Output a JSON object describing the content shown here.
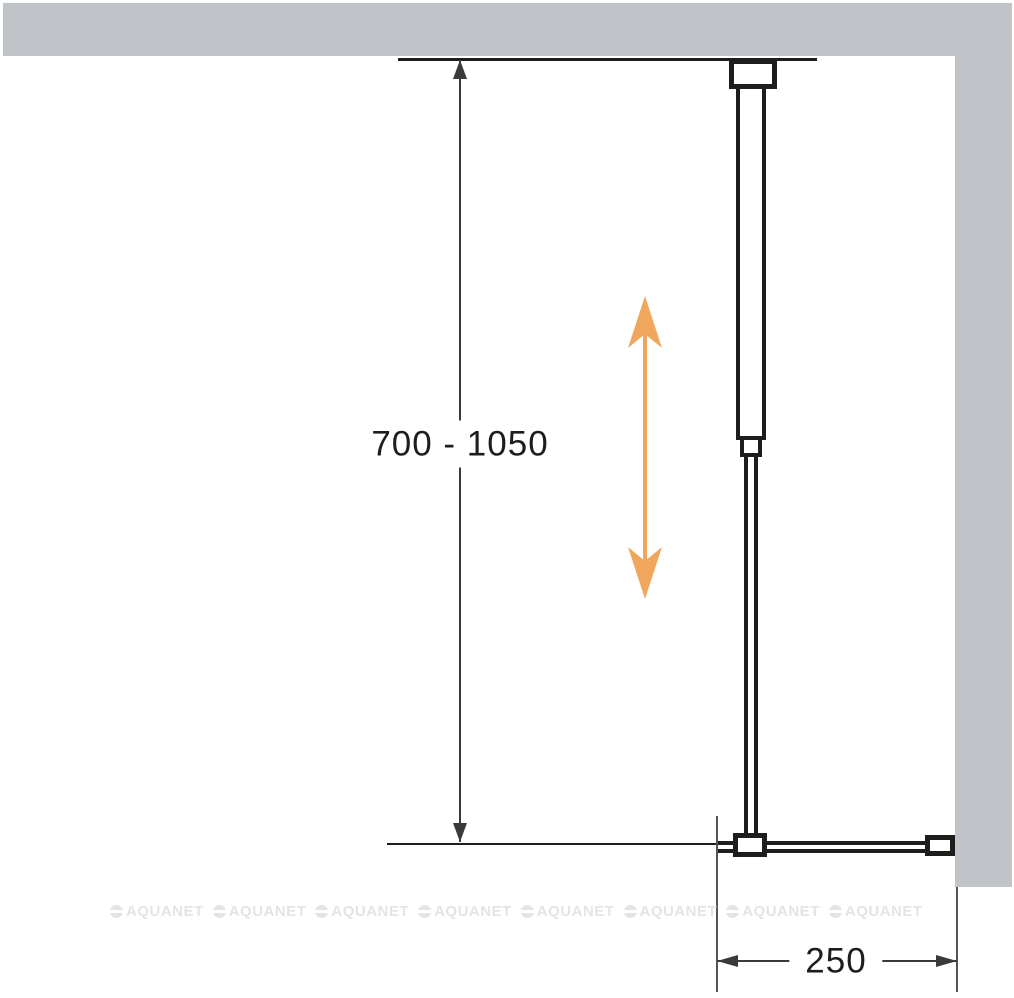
{
  "diagram": {
    "height_dimension_label": "700 - 1050",
    "width_dimension_label": "250",
    "icons": {
      "adjustment_arrow": "double-headed-vertical-arrow",
      "height_dimension_arrows": "up-arrow-and-down-arrow",
      "width_dimension_arrows": "left-arrow-and-right-arrow"
    }
  },
  "watermark": {
    "label": "AQUANET",
    "count": 8
  },
  "colors": {
    "wall_gray": "#c0c3c8",
    "line_black": "#1d1d1b",
    "dimension_gray": "#3a3a3a",
    "extension_gray": "#555555",
    "accent_orange": "#f0a65c",
    "watermark_gray": "#e3e4e6",
    "background": "#ffffff"
  }
}
